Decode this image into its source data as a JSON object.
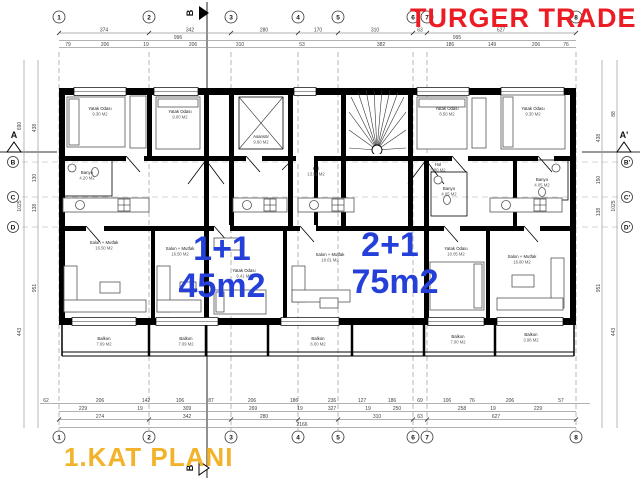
{
  "title": {
    "company": "TURGER TRADE",
    "plan": "1.KAT PLANI"
  },
  "apartments": {
    "left": {
      "type": "1+1",
      "area": "45m2"
    },
    "right": {
      "type": "2+1",
      "area": "75m2"
    }
  },
  "colors": {
    "company_red": "#ec1c24",
    "plan_yellow": "#f2b32b",
    "apartment_blue": "#2540d9"
  },
  "axes": {
    "top": [
      "1",
      "2",
      "3",
      "4",
      "5",
      "6",
      "7",
      "8"
    ],
    "bottom": [
      "1",
      "2",
      "3",
      "4",
      "5",
      "6",
      "7",
      "8"
    ],
    "left": [
      "B",
      "C",
      "D"
    ],
    "right": [
      "B'",
      "C'",
      "D'"
    ],
    "section_left": "A",
    "section_right": "A'",
    "section_top": "B",
    "section_bottom": "B"
  },
  "dims": {
    "t1": [
      "374",
      "342",
      "280",
      "170",
      "310",
      "63",
      "627"
    ],
    "t2": [
      "996",
      "995"
    ],
    "t3": [
      "79",
      "206",
      "19",
      "206",
      "310",
      "53",
      "382",
      "186",
      "149",
      "206",
      "76"
    ],
    "b1": [
      "62",
      "206",
      "142",
      "106",
      "87",
      "206",
      "186",
      "236",
      "127",
      "186",
      "69",
      "106",
      "76",
      "206",
      "57"
    ],
    "b2": [
      "229",
      "19",
      "309",
      "269",
      "19",
      "327",
      "19",
      "250",
      "258",
      "19",
      "229"
    ],
    "b3": [
      "274",
      "342",
      "280",
      "310",
      "63",
      "627"
    ],
    "total_width": "2166",
    "li": [
      "438",
      "130",
      "138",
      "951"
    ],
    "lo": [
      "690",
      "1025",
      "443"
    ],
    "ri": [
      "438",
      "150",
      "138",
      "951"
    ],
    "ro": [
      "88",
      "1025",
      "443"
    ]
  },
  "rooms": [
    {
      "n": "Yatak Odası",
      "a": "9.30 M2"
    },
    {
      "n": "Yatak Odası",
      "a": "9.00 M2"
    },
    {
      "n": "Asansör",
      "a": "9.60 M2"
    },
    {
      "n": "Yatak Odası",
      "a": "8.50 M2"
    },
    {
      "n": "Yatak Odası",
      "a": "9.30 M2"
    },
    {
      "n": "Banyo",
      "a": "4.20 M2"
    },
    {
      "n": "Hol",
      "a": "13.91 M2"
    },
    {
      "n": "Hol",
      "a": "5.80 M2"
    },
    {
      "n": "Banyo",
      "a": "4.05 M2"
    },
    {
      "n": "Banyo",
      "a": "4.05 M2"
    },
    {
      "n": "Salon + Mutfak",
      "a": "16.50 M2"
    },
    {
      "n": "Salon + Mutfak",
      "a": "16.50 M2"
    },
    {
      "n": "Yatak Odası",
      "a": "9.41 M2"
    },
    {
      "n": "Salon + Mutfak",
      "a": "18.01 M2"
    },
    {
      "n": "Yatak Odası",
      "a": "10.05 M2"
    },
    {
      "n": "Salon + Mutfak",
      "a": "16.80 M2"
    },
    {
      "n": "Balkon",
      "a": "7.09 M2"
    },
    {
      "n": "Balkon",
      "a": "7.09 M2"
    },
    {
      "n": "Balkon",
      "a": "6.00 M2"
    },
    {
      "n": "Balkon",
      "a": "7.00 M2"
    },
    {
      "n": "Balkon",
      "a": "3.98 M2"
    }
  ]
}
